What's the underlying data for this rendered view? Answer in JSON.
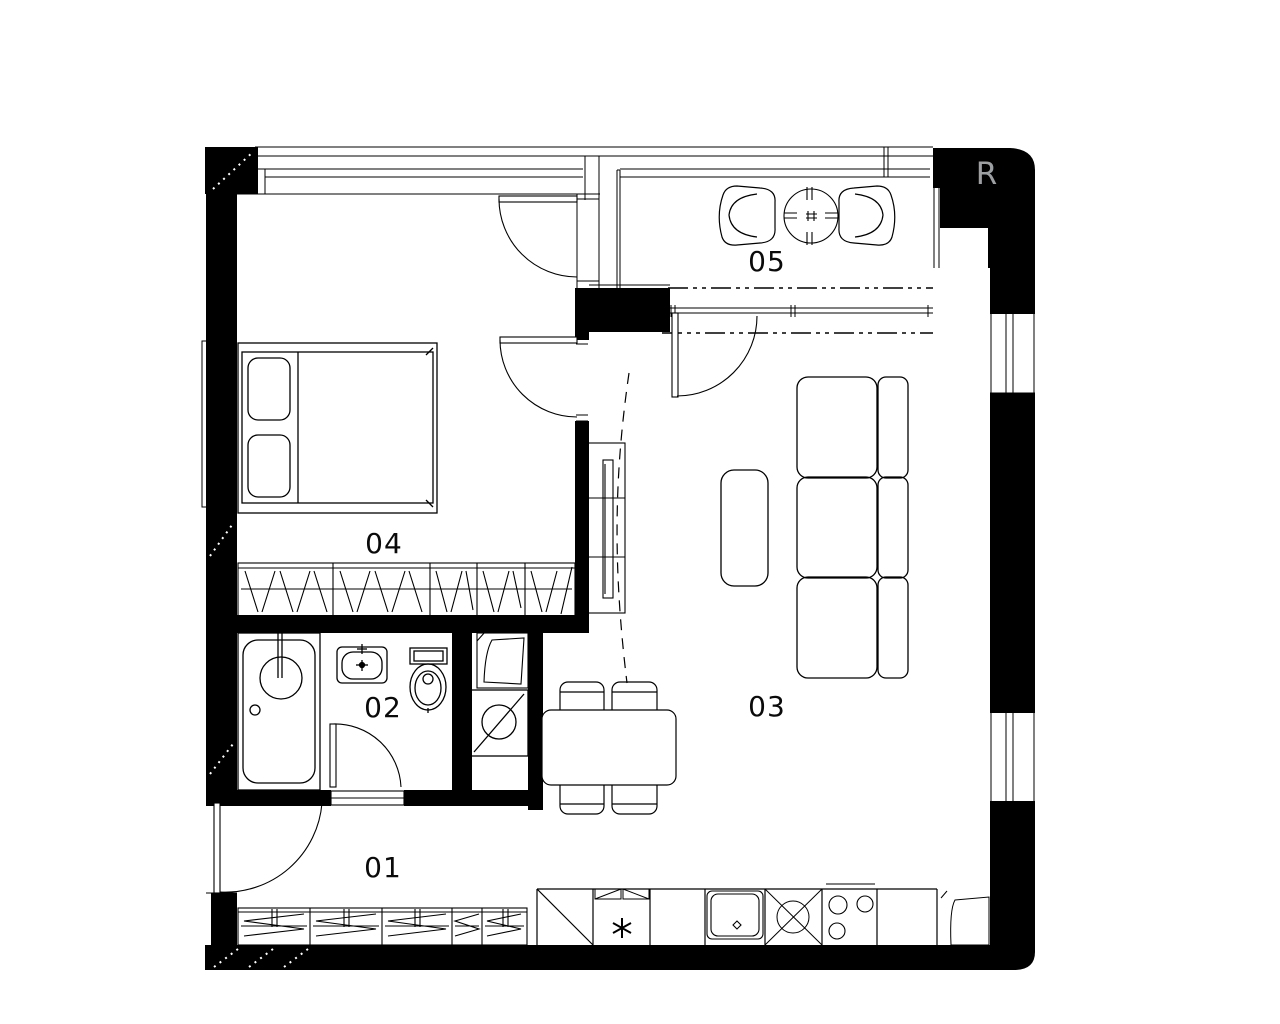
{
  "plan": {
    "rooms": [
      {
        "number": "01"
      },
      {
        "number": "02"
      },
      {
        "number": "03"
      },
      {
        "number": "04"
      },
      {
        "number": "05"
      }
    ],
    "corner_mark": "R"
  },
  "colors": {
    "walls": "#000000",
    "background": "#ffffff",
    "lines": "#000000",
    "corner_mark": "#9ca0a3"
  }
}
